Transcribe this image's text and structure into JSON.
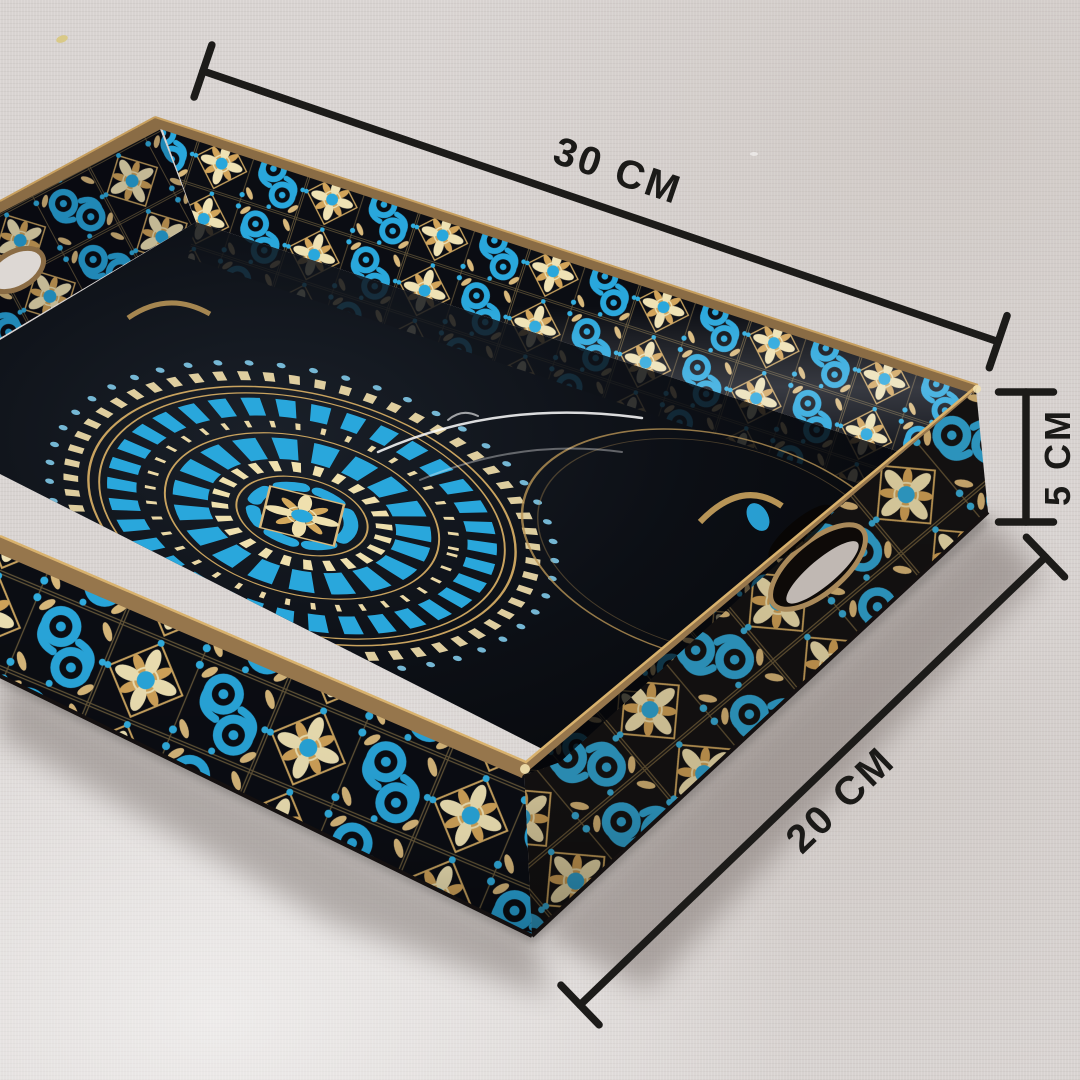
{
  "scene": {
    "subject": "Hand-painted black wooden serving tray with Moroccan tile pattern and gold-blue mandala, photographed at an angle on a light linen fabric backdrop",
    "annotation_style": "black dimension lines with perpendicular end caps"
  },
  "dimensions": {
    "width": {
      "label": "30 CM"
    },
    "depth": {
      "label": "20 CM"
    },
    "height": {
      "label": "5 CM"
    }
  },
  "colors": {
    "fabric": "#d8d3d1",
    "dimension_line": "#1c1b19",
    "lacquer_black": "#0b0d13",
    "pattern_blue": "#29a7dc",
    "pattern_blue_light": "#8fd4ef",
    "pattern_gold": "#d9b97c",
    "pattern_cream": "#efe2b4",
    "wood_bronze": "#8a6c45"
  }
}
